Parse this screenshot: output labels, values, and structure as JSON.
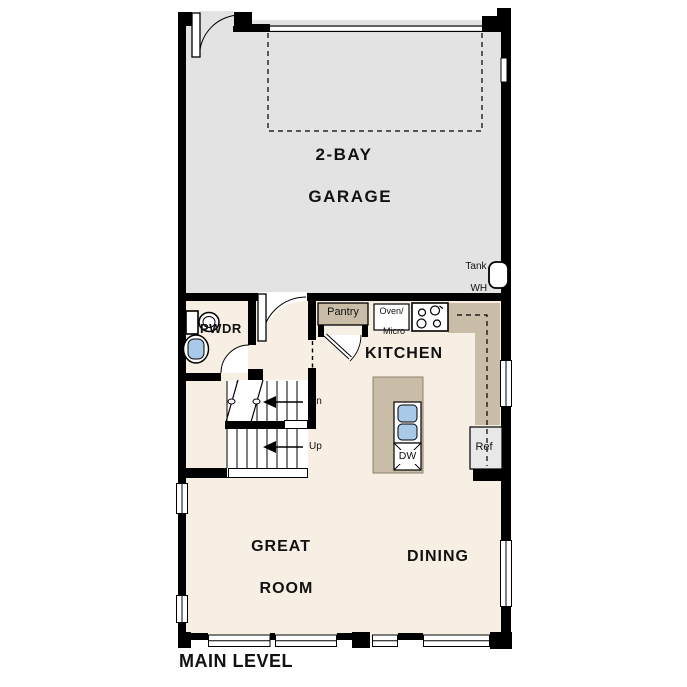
{
  "plan": {
    "level_label": "MAIN LEVEL",
    "rooms": {
      "garage": {
        "label_line1": "2-BAY",
        "label_line2": "GARAGE"
      },
      "powder": {
        "label": "PWDR"
      },
      "kitchen": {
        "label": "KITCHEN"
      },
      "great_room": {
        "label_line1": "GREAT",
        "label_line2": "ROOM"
      },
      "dining": {
        "label": "DINING"
      }
    },
    "fixtures": {
      "pantry": {
        "label": "Pantry"
      },
      "oven_micro": {
        "label_line1": "Oven/",
        "label_line2": "Micro"
      },
      "water_heater": {
        "label_line1": "Tank",
        "label_line2": "WH"
      },
      "refrigerator": {
        "label": "Ref"
      },
      "dishwasher": {
        "label": "DW"
      }
    },
    "stairs": {
      "down_label": "Dn",
      "up_label": "Up"
    }
  },
  "colors": {
    "wall": "#000000",
    "garage_floor": "#e3e3e3",
    "living_floor": "#f7efe3",
    "cabinet_tan": "#c9bda8",
    "sink_blue": "#a9c9e9",
    "appliance_gray": "#e8e8e8"
  }
}
